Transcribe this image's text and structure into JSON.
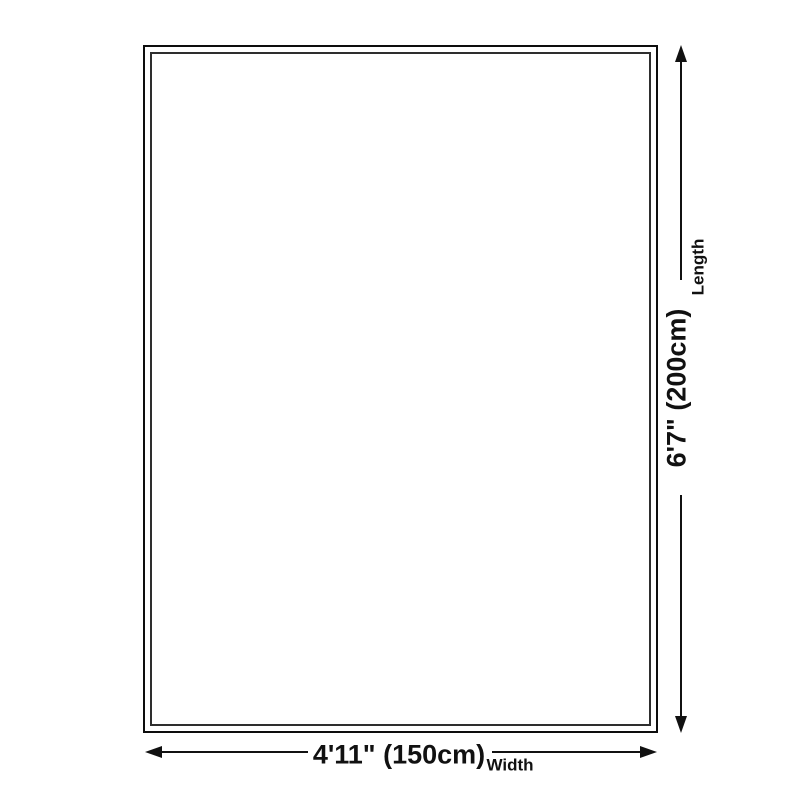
{
  "diagram": {
    "type": "product-dimension-diagram",
    "length": {
      "value": "6'7\" (200cm)",
      "label": "Length"
    },
    "width": {
      "value": "4'11\" (150cm)",
      "label": "Width"
    },
    "colors": {
      "background": "#ffffff",
      "line": "#111111",
      "outer_border": "#0d0d0d",
      "inner_border": "#2e2e2e"
    }
  }
}
